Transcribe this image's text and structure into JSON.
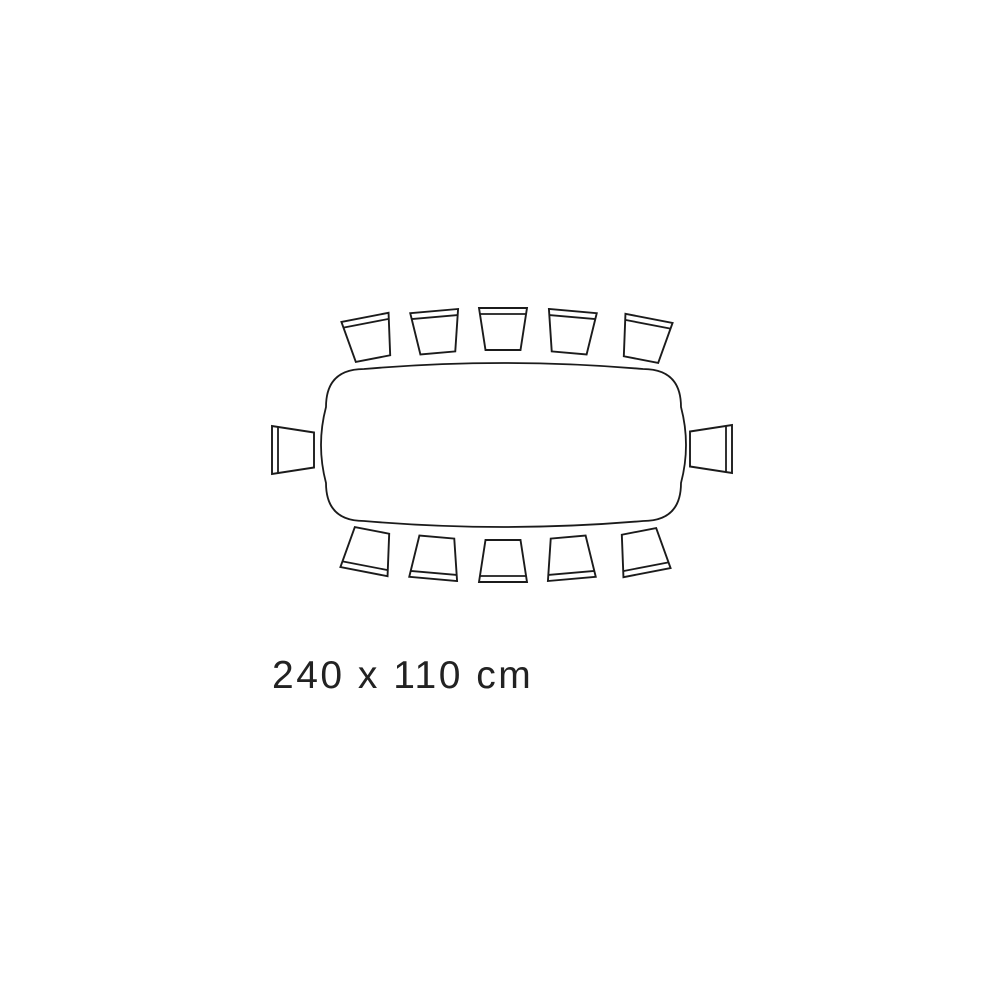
{
  "page": {
    "background": "#ffffff"
  },
  "diagram": {
    "kind": "table-seating-plan-top-view",
    "dimension_label": "240 x 110 cm",
    "table_length_cm": 240,
    "table_width_cm": 110,
    "seat_count": 12,
    "line_color": "#1b1b1b",
    "fill_color": "#ffffff",
    "table": {
      "left": 326,
      "top": 369,
      "right": 681,
      "bottom": 521,
      "corner": 38,
      "long_edge_bow": 6,
      "short_edge_bow": 5
    },
    "chair_shape": {
      "back_half_width": 24,
      "front_half_width": 17.5,
      "half_depth": 21,
      "backrest_bar_inset": 6
    },
    "chairs": [
      {
        "id": "chair-top-1",
        "cx": 369,
        "cy": 338,
        "rotation": -11
      },
      {
        "id": "chair-top-2",
        "cx": 436,
        "cy": 332,
        "rotation": -5
      },
      {
        "id": "chair-top-3",
        "cx": 503,
        "cy": 329,
        "rotation": 0
      },
      {
        "id": "chair-top-4",
        "cx": 571,
        "cy": 332,
        "rotation": 5
      },
      {
        "id": "chair-top-5",
        "cx": 645,
        "cy": 339,
        "rotation": 11
      },
      {
        "id": "chair-right",
        "cx": 711,
        "cy": 449,
        "rotation": 90
      },
      {
        "id": "chair-bottom-5",
        "cx": 643,
        "cy": 552,
        "rotation": 169
      },
      {
        "id": "chair-bottom-4",
        "cx": 570,
        "cy": 558,
        "rotation": 175
      },
      {
        "id": "chair-bottom-3",
        "cx": 503,
        "cy": 561,
        "rotation": 180
      },
      {
        "id": "chair-bottom-2",
        "cx": 435,
        "cy": 558,
        "rotation": 185
      },
      {
        "id": "chair-bottom-1",
        "cx": 368,
        "cy": 551,
        "rotation": 191
      },
      {
        "id": "chair-left",
        "cx": 293,
        "cy": 450,
        "rotation": -90
      }
    ]
  }
}
